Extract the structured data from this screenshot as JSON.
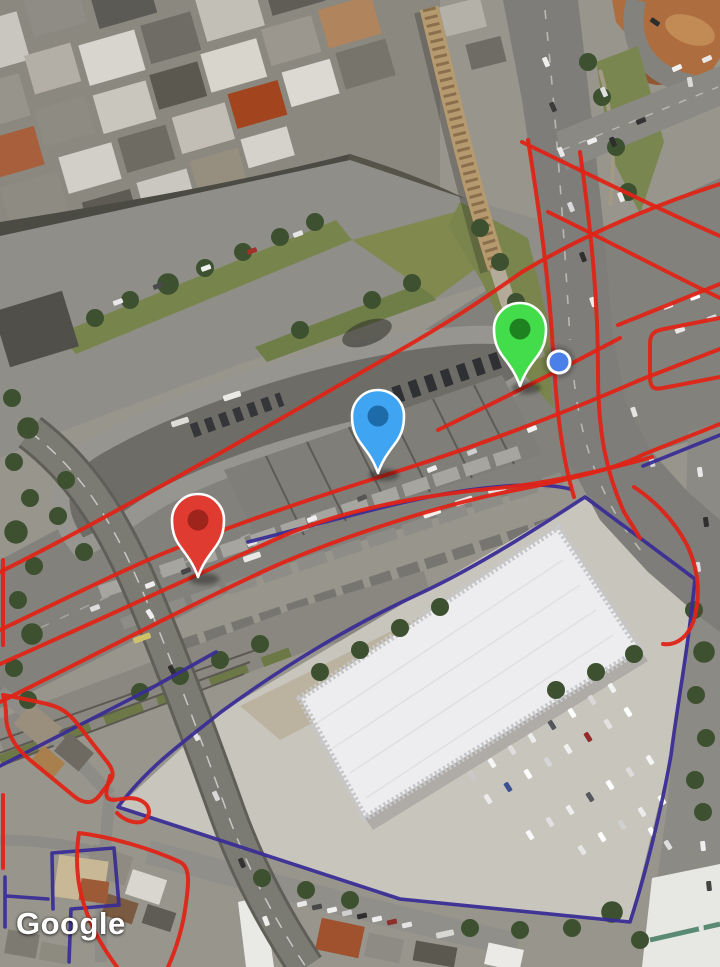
{
  "map": {
    "attribution": "Google",
    "markers": [
      {
        "name": "red",
        "body": "#E03B30",
        "inner": "#9E241C",
        "x": 198,
        "y": 577
      },
      {
        "name": "blue",
        "body": "#3FA4F2",
        "inner": "#1D6BA8",
        "x": 378,
        "y": 473
      },
      {
        "name": "green",
        "body": "#43DD4B",
        "inner": "#1E8221",
        "x": 520,
        "y": 386
      }
    ],
    "location_dot": {
      "x": 559,
      "y": 362,
      "fill": "#4A80E8",
      "ring": "#FFFFFF"
    },
    "overlays": {
      "red": {
        "color": "#DF2417",
        "width": 4,
        "paths": [
          "M 0 572 C 120 512 300 408 388 357 C 450 322 482 300 522 272 C 575 240 645 208 720 184",
          "M 0 630 C 60 601 140 562 172 550 C 242 521 332 492 392 473 C 472 448 565 413 640 380 L 720 349",
          "M 438 430 C 500 400 560 370 620 338",
          "M 0 664 C 100 620 215 566 283 536 C 352 506 442 493 498 488 C 545 484 606 470 652 457",
          "M 0 702 C 95 655 215 592 282 563 C 352 533 452 502 516 490 C 572 479 618 468 642 455 L 720 424",
          "M 522 142 C 590 175 652 206 720 236",
          "M 548 212 C 612 243 666 272 720 298",
          "M 528 140 C 540 215 548 275 552 335 C 556 402 560 450 574 497",
          "M 580 152 C 592 237 598 302 598 372 C 598 432 606 472 624 512 L 640 538",
          "M 618 325 L 720 284",
          "M 720 318 L 664 329 C 652 331 650 336 650 344 L 650 377 C 650 388 654 390 663 388 L 720 377",
          "M 634 487 C 654 500 674 520 687 545 C 697 566 701 590 695 616 C 690 635 678 646 663 644",
          "M 3 695 C 20 698 35 701 47 704 C 60 707 67 712 75 721 L 108 763 C 114 771 114 777 109 783 L 99 796 C 92 805 83 803 75 797 L 30 760 C 12 745 6 730 6 715 C 6 704 4 699 3 695 Z",
          "M 110 776 C 107 788 104 796 109 799 C 116 802 126 796 137 799 C 147 802 152 810 147 818 C 141 826 126 822 117 813",
          "M 79 833 C 112 837 152 849 180 862 C 190 867 189 882 186 903 C 183 928 176 949 168 967 M 79 833 C 76 852 76 872 81 894 C 88 922 100 944 117 967",
          "M 3 560 L 3 645 M 3 795 L 3 868"
        ]
      },
      "purple": {
        "color": "#3A2D96",
        "width": 3.6,
        "paths": [
          "M 585 497 L 695 579 C 688 650 678 700 671 755 C 665 790 650 860 630 922 L 400 899 L 118 807 C 149 766 181 744 221 712 C 281 668 351 625 421 593 C 481 565 545 523 585 497 Z",
          "M 248 542 C 320 524 402 500 462 491 C 502 485 542 482 570 489",
          "M 0 766 L 148 690 L 216 652",
          "M 53 909 L 52 853 L 114 848 L 119 905 L 71 909 L 69 962",
          "M 5 877 L 5 927 M 6 896 L 48 899",
          "M 643 466 L 720 435"
        ]
      }
    }
  }
}
